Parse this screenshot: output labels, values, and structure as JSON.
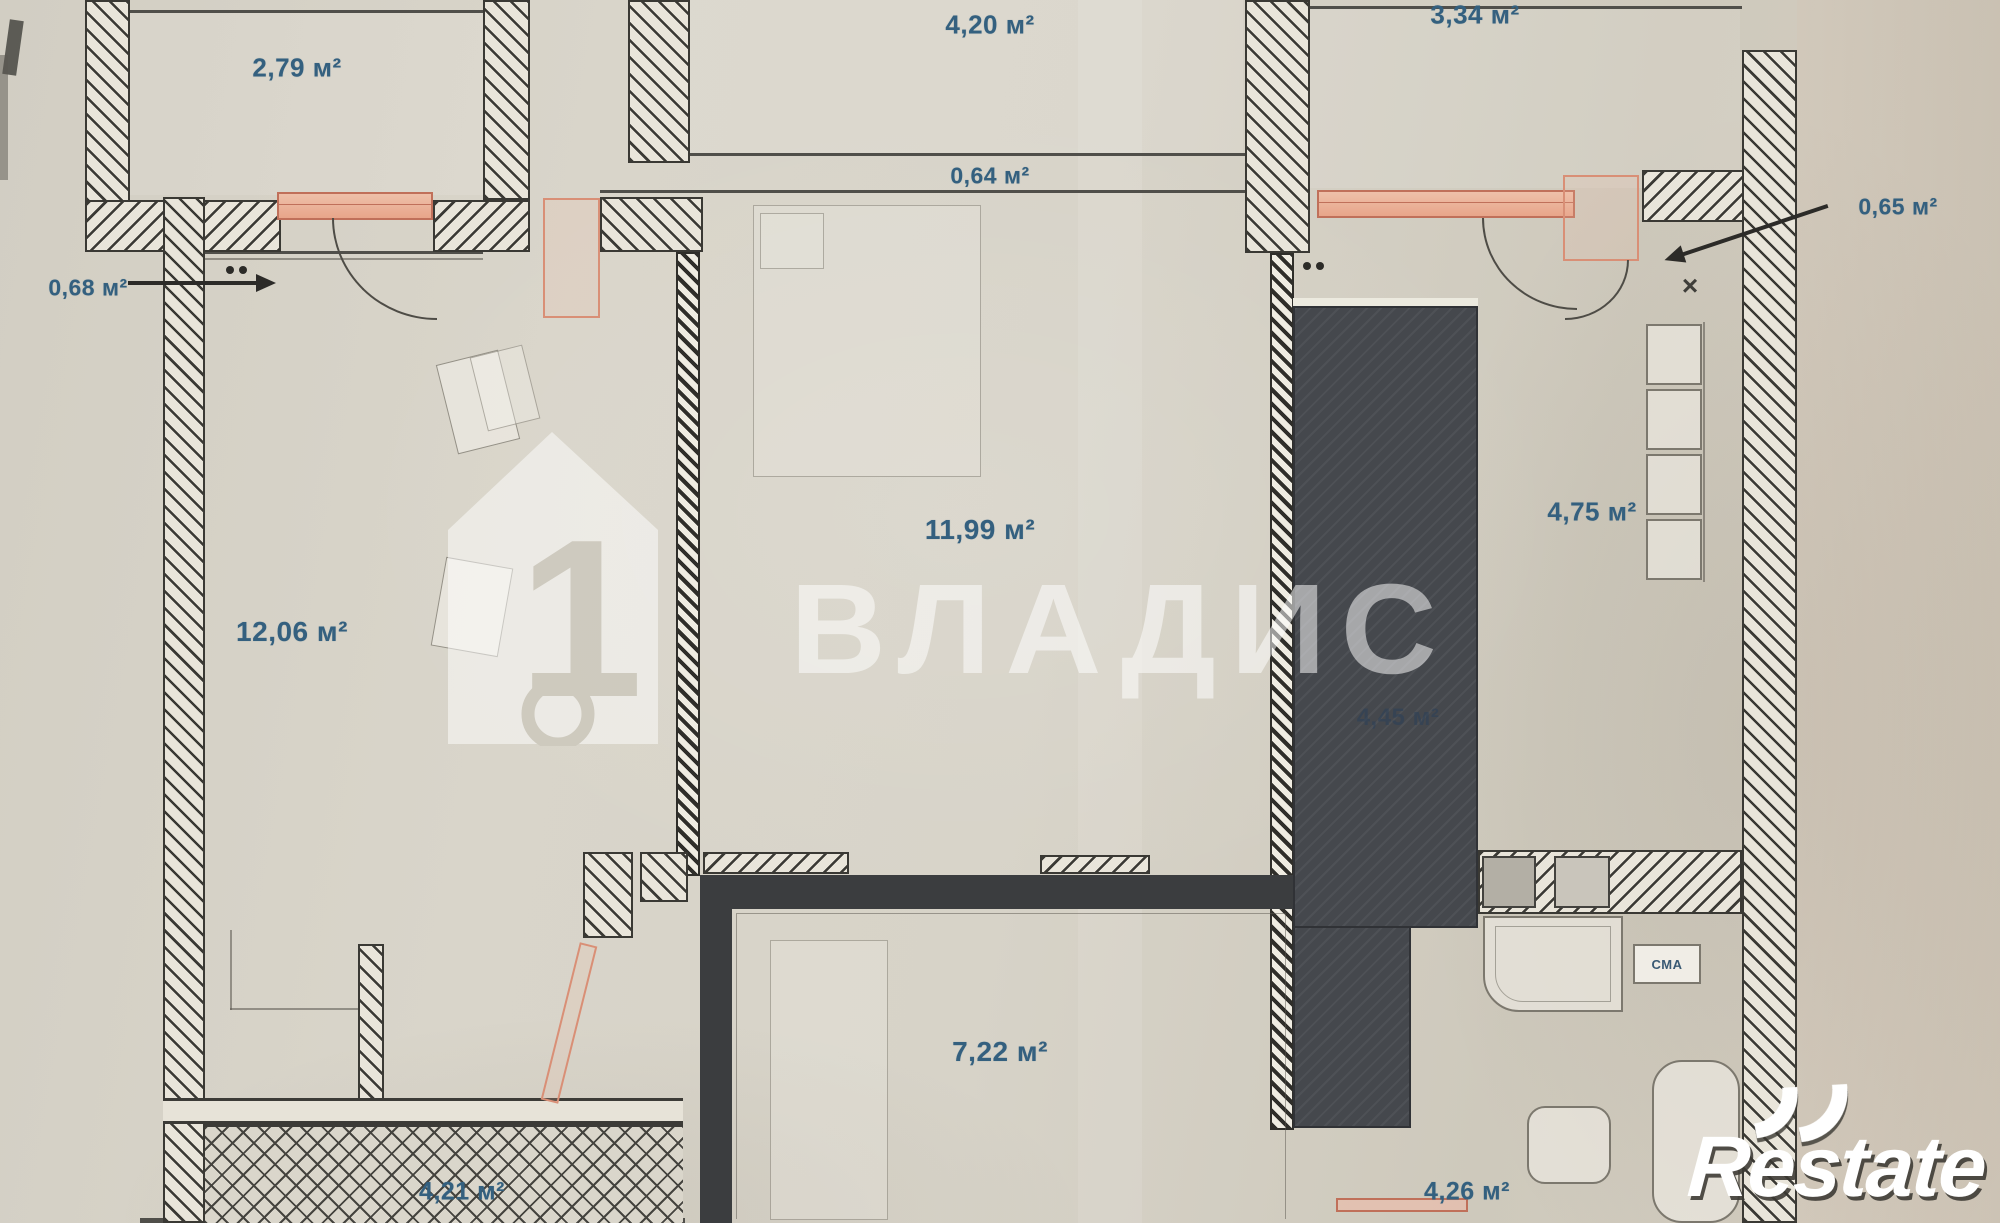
{
  "watermarks": {
    "vladis": "ВЛАДИС",
    "restate": "Restate"
  },
  "marks": {
    "x_mark": "×"
  },
  "fixtures": {
    "washing_machine": "СМА"
  },
  "colors": {
    "label_blue": "#34607f",
    "salmon": "#e9a88e",
    "wall_dark": "#33322e",
    "shaft_dark": "#45484d",
    "paper": "#d6d2c7"
  },
  "area_labels": [
    {
      "id": "balcony-top-left",
      "text": "2,79 м²",
      "x": 297,
      "y": 68,
      "size": 26
    },
    {
      "id": "hall-top",
      "text": "4,20 м²",
      "x": 990,
      "y": 25,
      "size": 26
    },
    {
      "id": "room-top-right",
      "text": "3,34 м²",
      "x": 1475,
      "y": 15,
      "size": 26
    },
    {
      "id": "strip-center",
      "text": "0,64 м²",
      "x": 990,
      "y": 176,
      "size": 23
    },
    {
      "id": "balcony-left",
      "text": "0,68 м²",
      "x": 88,
      "y": 288,
      "size": 23
    },
    {
      "id": "niche-right",
      "text": "0,65 м²",
      "x": 1898,
      "y": 207,
      "size": 23
    },
    {
      "id": "room-left",
      "text": "12,06 м²",
      "x": 292,
      "y": 632,
      "size": 28
    },
    {
      "id": "room-center",
      "text": "11,99 м²",
      "x": 980,
      "y": 530,
      "size": 28
    },
    {
      "id": "kitchen-right",
      "text": "4,75 м²",
      "x": 1592,
      "y": 512,
      "size": 26
    },
    {
      "id": "shaft",
      "text": "4,45 м²",
      "x": 1398,
      "y": 718,
      "size": 24,
      "variant": "dim"
    },
    {
      "id": "room-bottom-center",
      "text": "7,22 м²",
      "x": 1000,
      "y": 1052,
      "size": 28
    },
    {
      "id": "bathroom",
      "text": "4,26 м²",
      "x": 1467,
      "y": 1192,
      "size": 25
    },
    {
      "id": "balcony-bottom-left",
      "text": "4,21 м²",
      "x": 462,
      "y": 1192,
      "size": 25
    }
  ]
}
